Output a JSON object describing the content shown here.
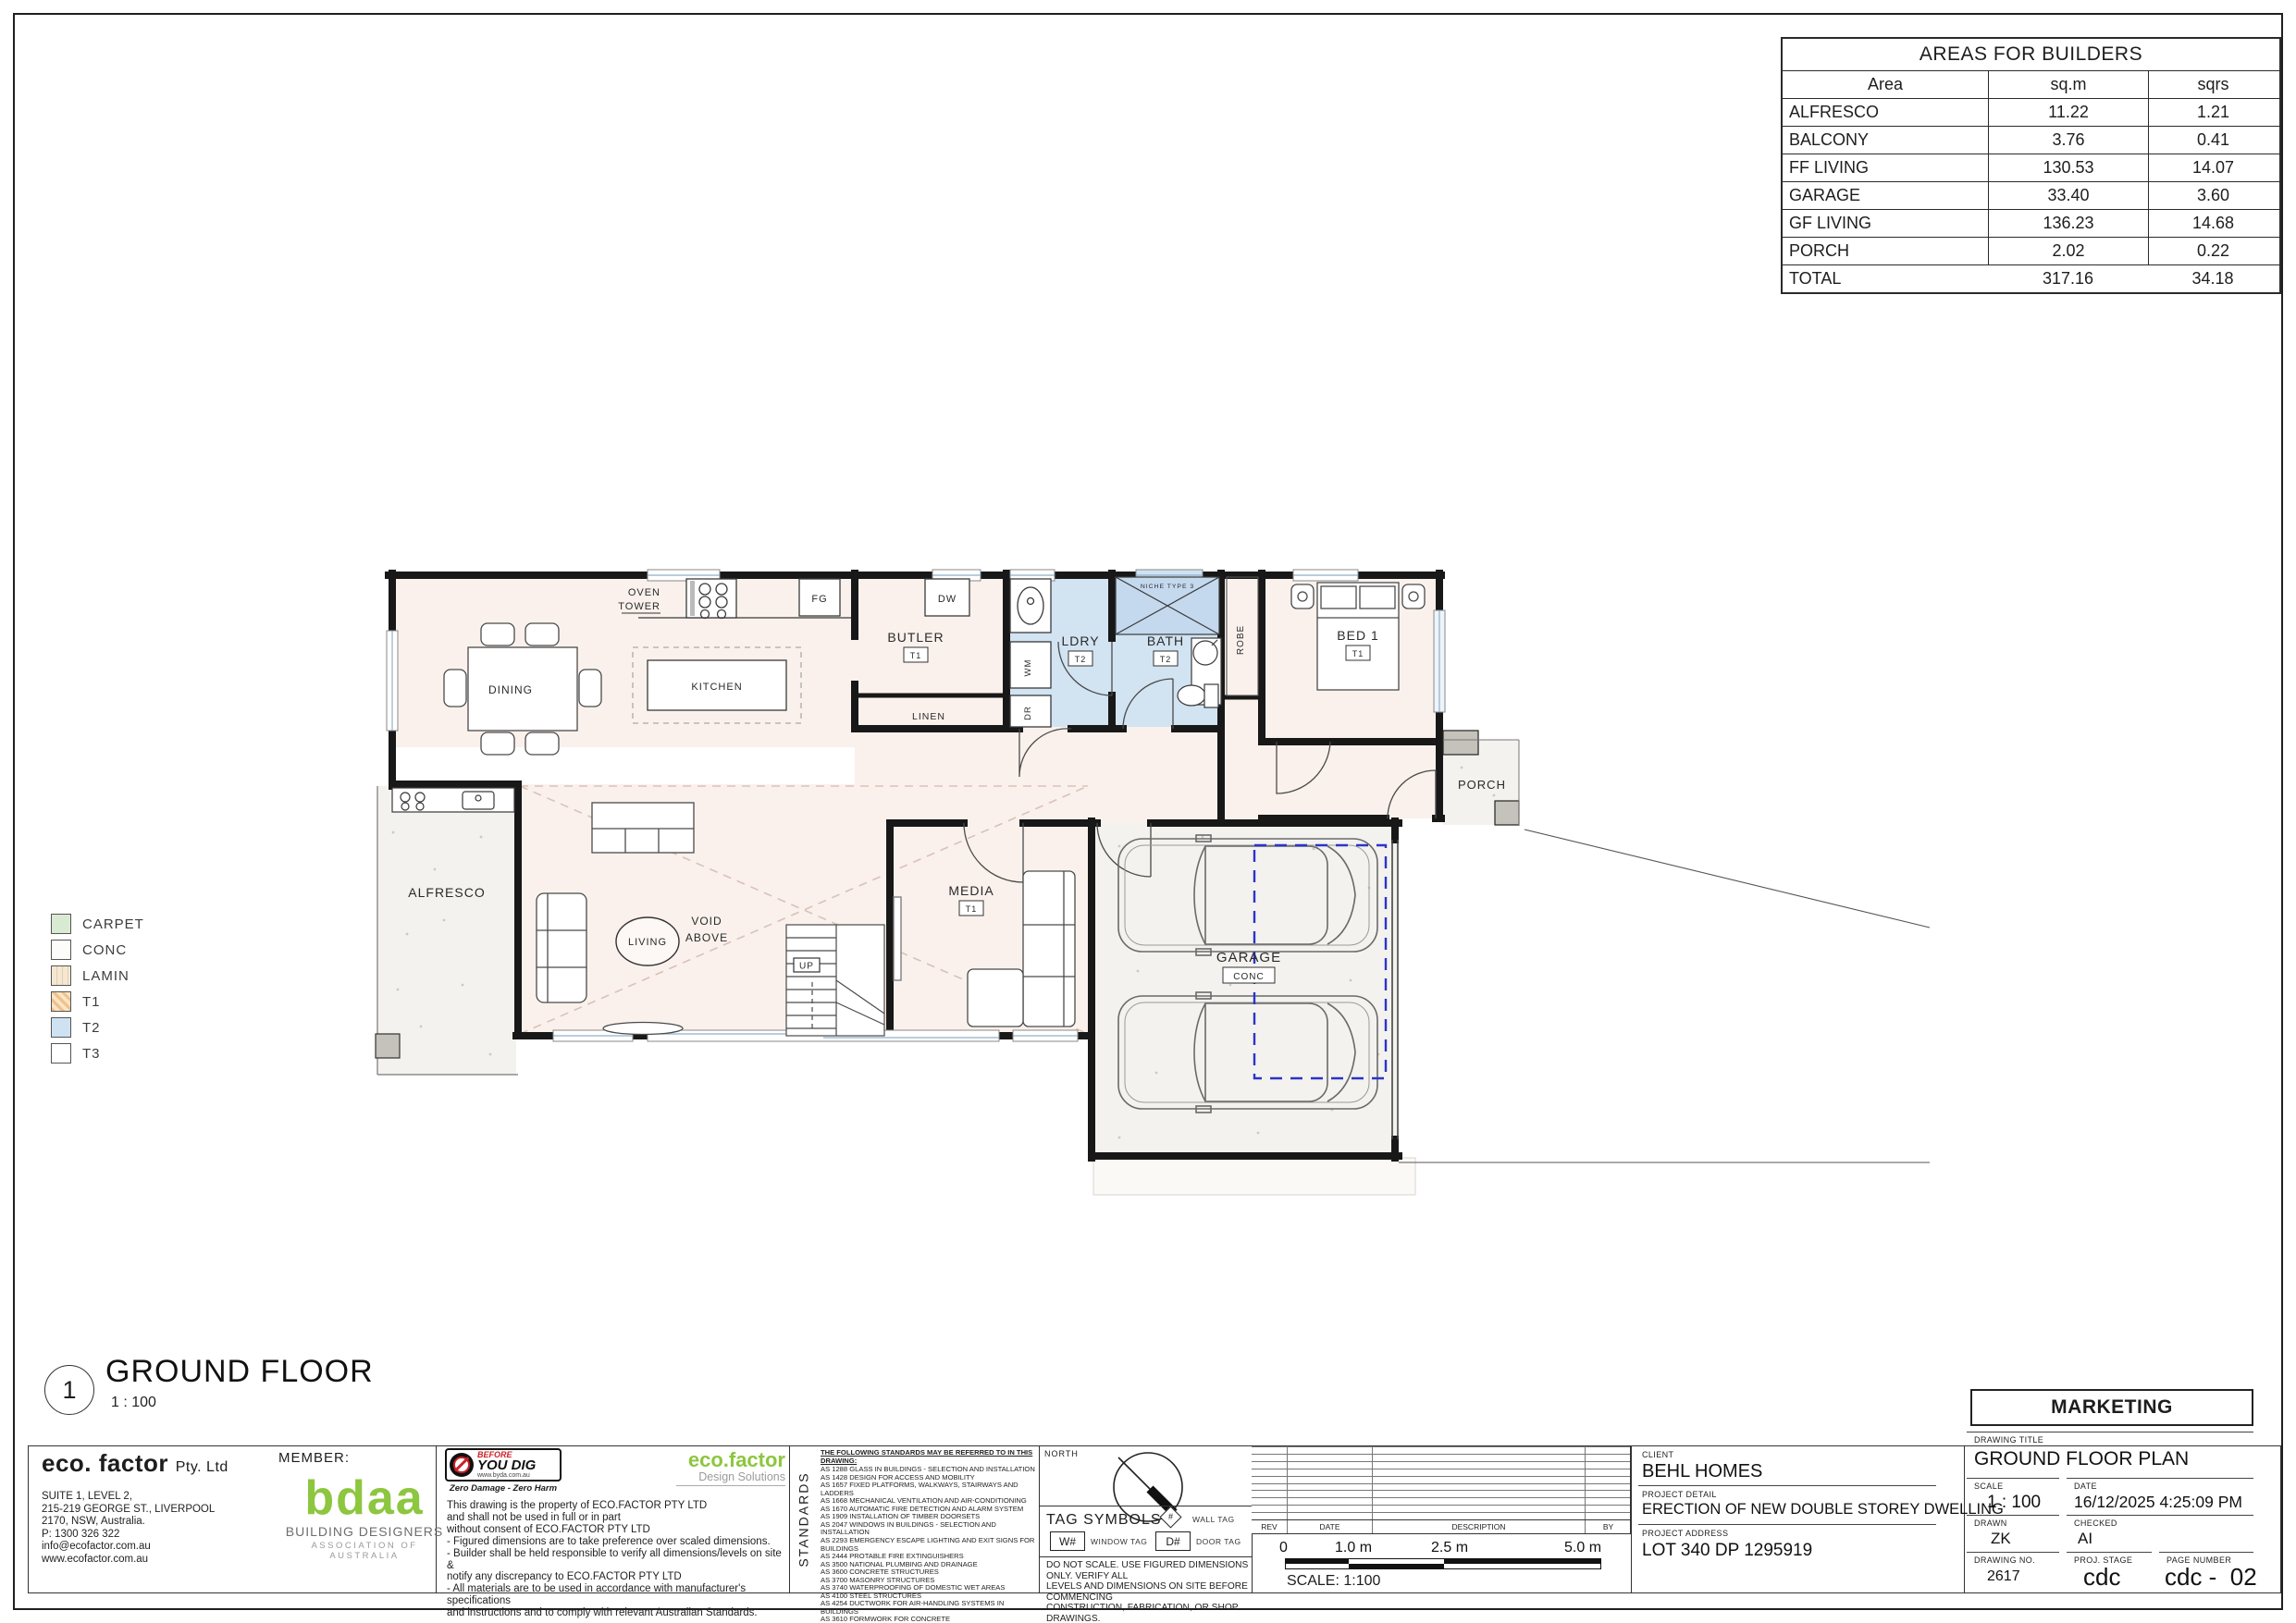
{
  "colors": {
    "floor_warm": "#faf1ec",
    "tile_blue": "#cfe2f2",
    "concrete": "#f3f2ee",
    "brand_green": "#8dc63f",
    "byd_red": "#cc2127",
    "garage_dash_blue": "#2b35c8"
  },
  "areas_table": {
    "title": "AREAS FOR BUILDERS",
    "columns": [
      "Area",
      "sq.m",
      "sqrs"
    ],
    "rows": [
      {
        "area": "ALFRESCO",
        "sqm": "11.22",
        "sqrs": "1.21"
      },
      {
        "area": "BALCONY",
        "sqm": "3.76",
        "sqrs": "0.41"
      },
      {
        "area": "FF LIVING",
        "sqm": "130.53",
        "sqrs": "14.07"
      },
      {
        "area": "GARAGE",
        "sqm": "33.40",
        "sqrs": "3.60"
      },
      {
        "area": "GF LIVING",
        "sqm": "136.23",
        "sqrs": "14.68"
      },
      {
        "area": "PORCH",
        "sqm": "2.02",
        "sqrs": "0.22"
      }
    ],
    "total": {
      "area": "TOTAL",
      "sqm": "317.16",
      "sqrs": "34.18"
    }
  },
  "legend": {
    "items": [
      {
        "key": "carpet",
        "label": "CARPET"
      },
      {
        "key": "conc",
        "label": "CONC"
      },
      {
        "key": "lamin",
        "label": "LAMIN"
      },
      {
        "key": "t1",
        "label": "T1"
      },
      {
        "key": "t2",
        "label": "T2"
      },
      {
        "key": "t3",
        "label": "T3"
      }
    ]
  },
  "plan": {
    "labels": {
      "oven": "OVEN",
      "tower": "TOWER",
      "fg": "FG",
      "dw": "DW",
      "butler": "BUTLER",
      "wm": "WM",
      "dr": "DR",
      "ldry": "LDRY",
      "bath": "BATH",
      "niche": "NICHE TYPE 3",
      "robe": "ROBE",
      "bed1": "BED 1",
      "linen": "LINEN",
      "porch": "PORCH",
      "dining": "DINING",
      "kitchen": "KITCHEN",
      "alfresco": "ALFRESCO",
      "living": "LIVING",
      "void1": "VOID",
      "void2": "ABOVE",
      "up": "UP",
      "media": "MEDIA",
      "garage": "GARAGE"
    },
    "tags": {
      "t1": "T1",
      "t2": "T2",
      "conc": "CONC"
    }
  },
  "sheet_title": {
    "number": "1",
    "title": "GROUND FLOOR",
    "scale": "1 : 100"
  },
  "footer": {
    "company": {
      "name": "eco. factor",
      "suffix": "Pty. Ltd",
      "address_lines": [
        "SUITE 1, LEVEL 2,",
        "215-219 GEORGE ST., LIVERPOOL",
        "2170, NSW, Australia.",
        "P: 1300 326 322",
        "info@ecofactor.com.au",
        "www.ecofactor.com.au"
      ],
      "member_label": "MEMBER:",
      "bdaa_word": "bdaa",
      "bdaa_line1": "BUILDING DESIGNERS",
      "bdaa_line2": "ASSOCIATION OF AUSTRALIA"
    },
    "byd": {
      "line1": "BEFORE",
      "line2": "YOU DIG",
      "url": "www.byda.com.au",
      "tagline": "Zero Damage - Zero Harm"
    },
    "brand": {
      "name": "eco.factor",
      "tagline": "Design Solutions"
    },
    "disclaimer_lines": [
      "This drawing is the property of ECO.FACTOR PTY LTD",
      "and shall not be used in full or in part",
      "without consent of ECO.FACTOR PTY LTD",
      "- Figured dimensions are to take preference over scaled dimensions.",
      "- Builder shall be held responsible to verify all dimensions/levels on site &",
      "notify any discrepancy to ECO.FACTOR PTY LTD",
      "- All materials are to be used in accordance with manufacturer's specifications",
      "and instructions and to comply with relevant Australian Standards."
    ],
    "standards": {
      "vertical_label": "STANDARDS",
      "header": "THE FOLLOWING STANDARDS MAY BE REFERRED TO IN THIS DRAWING:",
      "items": [
        "AS 1288  GLASS IN BUILDINGS - SELECTION AND INSTALLATION",
        "AS 1428  DESIGN FOR ACCESS AND MOBILITY",
        "AS 1657  FIXED PLATFORMS, WALKWAYS, STAIRWAYS AND LADDERS",
        "AS 1668  MECHANICAL VENTILATION AND AIR-CONDITIONING",
        "AS 1670  AUTOMATIC FIRE DETECTION AND ALARM SYSTEM",
        "AS 1909  INSTALLATION OF TIMBER DOORSETS",
        "AS 2047  WINDOWS IN BUILDINGS - SELECTION AND INSTALLATION",
        "AS 2293  EMERGENCY ESCAPE LIGHTING AND EXIT SIGNS FOR BUILDINGS",
        "AS 2444  PROTABLE FIRE EXTINGUISHERS",
        "AS 3500  NATIONAL PLUMBING AND DRAINAGE",
        "AS 3600  CONCRETE STRUCTURES",
        "AS 3700  MASONRY STRUCTURES",
        "AS 3740  WATERPROOFING OF DOMESTIC WET AREAS",
        "AS 4100  STEEL STRUCTURES",
        "AS 4254  DUCTWORK FOR AIR-HANDLING SYSTEMS IN BUILDINGS",
        "AS 3610  FORMWORK FOR CONCRETE",
        "OTHER ALTERNATIVE SOLUTION"
      ]
    },
    "north_label": "NORTH",
    "tag_symbols": {
      "title": "TAG SYMBOLS",
      "window_tag": "W#",
      "window_label": "WINDOW TAG",
      "wall_tag": "#",
      "wall_label": "WALL TAG",
      "door_tag": "D#",
      "door_label": "DOOR TAG"
    },
    "notes_lines": [
      "DO NOT SCALE. USE FIGURED DIMENSIONS ONLY. VERIFY ALL",
      "LEVELS AND DIMENSIONS ON SITE BEFORE COMMENCING",
      "CONSTRUCTION, FABRICATION, OR SHOP DRAWINGS.",
      "© COPYRIGHT - ALL RIGHTS RESERVED"
    ],
    "revisions": {
      "columns": [
        "REV",
        "DATE",
        "DESCRIPTION",
        "BY"
      ],
      "empty_rows": [
        "",
        "",
        "",
        "",
        "",
        "",
        "",
        "",
        "",
        ""
      ]
    },
    "scalebar": {
      "ticks": [
        "0",
        "1.0 m",
        "2.5 m",
        "5.0 m"
      ],
      "label": "SCALE: 1:100"
    },
    "project": {
      "client_label": "CLIENT",
      "client": "BEHL HOMES",
      "detail_label": "PROJECT DETAIL",
      "detail": "ERECTION OF NEW DOUBLE STOREY DWELLING",
      "address_label": "PROJECT ADDRESS",
      "address": "LOT 340 DP 1295919"
    },
    "titleblock": {
      "marketing": "MARKETING",
      "drawing_title_label": "DRAWING TITLE",
      "drawing_title": "GROUND FLOOR PLAN",
      "scale_label": "SCALE",
      "scale": "1 : 100",
      "date_label": "DATE",
      "date": "16/12/2025 4:25:09 PM",
      "drawn_label": "DRAWN",
      "drawn": "ZK",
      "checked_label": "CHECKED",
      "checked": "AI",
      "drawing_no_label": "DRAWING NO.",
      "drawing_no": "2617",
      "stage_label": "PROJ. STAGE",
      "stage": "cdc",
      "page_label": "PAGE NUMBER",
      "page": "cdc -  02"
    }
  }
}
